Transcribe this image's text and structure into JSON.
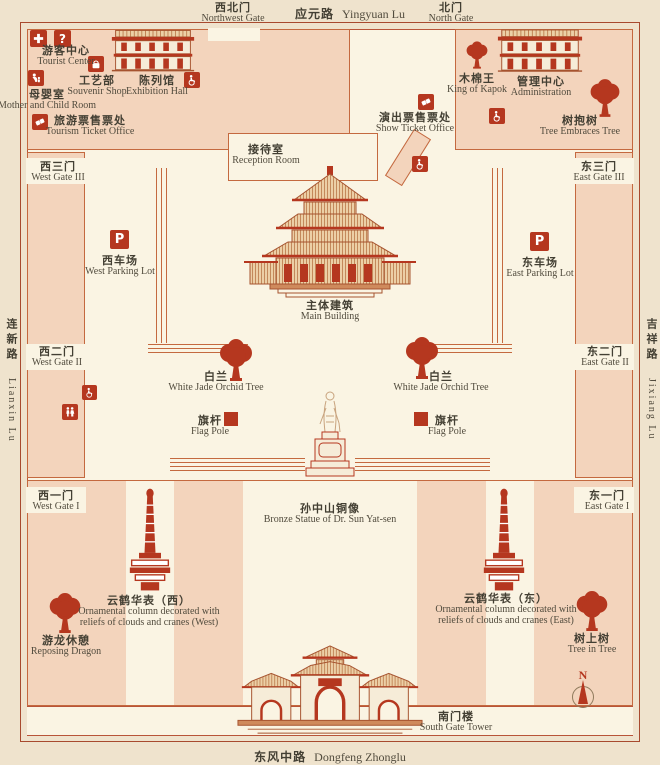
{
  "colors": {
    "accent": "#b5371f",
    "path_pink": "#f3d4bc",
    "outline": "#c4693f",
    "background": "#efe3cd",
    "paper": "#faf4e3",
    "ink": "#433f33"
  },
  "roads": {
    "top": {
      "zh": "应元路",
      "en": "Yingyuan Lu"
    },
    "bottom": {
      "zh": "东风中路",
      "en": "Dongfeng Zhonglu"
    },
    "left": {
      "zh": "连新路",
      "en": "Lianxin Lu"
    },
    "right": {
      "zh": "吉祥路",
      "en": "Jixiang Lu"
    }
  },
  "gates": {
    "northwest": {
      "zh": "西北门",
      "en": "Northwest Gate"
    },
    "north": {
      "zh": "北门",
      "en": "North Gate"
    },
    "west3": {
      "zh": "西三门",
      "en": "West Gate III"
    },
    "east3": {
      "zh": "东三门",
      "en": "East Gate III"
    },
    "west2": {
      "zh": "西二门",
      "en": "West Gate II"
    },
    "east2": {
      "zh": "东二门",
      "en": "East Gate II"
    },
    "west1": {
      "zh": "西一门",
      "en": "West Gate I"
    },
    "east1": {
      "zh": "东一门",
      "en": "East Gate I"
    }
  },
  "pois": {
    "tourist_center": {
      "zh": "游客中心",
      "en": "Tourist Center"
    },
    "souvenir_shop": {
      "zh": "工艺部",
      "en": "Souvenir Shop"
    },
    "exhibition_hall": {
      "zh": "陈列馆",
      "en": "Exhibition Hall"
    },
    "mother_child_room": {
      "zh": "母婴室",
      "en": "Mother and Child Room"
    },
    "tourism_ticket_office": {
      "zh": "旅游票售票处",
      "en": "Tourism Ticket Office"
    },
    "king_of_kapok": {
      "zh": "木棉王",
      "en": "King of Kapok"
    },
    "administration": {
      "zh": "管理中心",
      "en": "Administration"
    },
    "tree_embraces_tree": {
      "zh": "树抱树",
      "en": "Tree Embraces Tree"
    },
    "show_ticket_office": {
      "zh": "演出票售票处",
      "en": "Show Ticket Office"
    },
    "reception_room": {
      "zh": "接待室",
      "en": "Reception Room"
    },
    "main_building": {
      "zh": "主体建筑",
      "en": "Main Building"
    },
    "west_parking": {
      "zh": "西车场",
      "en": "West Parking Lot"
    },
    "east_parking": {
      "zh": "东车场",
      "en": "East Parking Lot"
    },
    "white_jade_orchid_west": {
      "zh": "白兰",
      "en": "White Jade Orchid Tree"
    },
    "white_jade_orchid_east": {
      "zh": "白兰",
      "en": "White Jade Orchid Tree"
    },
    "flag_pole_west": {
      "zh": "旗杆",
      "en": "Flag Pole"
    },
    "flag_pole_east": {
      "zh": "旗杆",
      "en": "Flag Pole"
    },
    "sun_yatsen_statue": {
      "zh": "孙中山铜像",
      "en": "Bronze Statue of Dr. Sun Yat-sen"
    },
    "ornamental_column_west": {
      "zh": "云鹤华表（西）",
      "en": "Ornamental column decorated with reliefs of clouds and cranes (West)"
    },
    "ornamental_column_east": {
      "zh": "云鹤华表（东）",
      "en": "Ornamental column decorated with reliefs of clouds and cranes (East)"
    },
    "reposing_dragon": {
      "zh": "游龙休憩",
      "en": "Reposing Dragon"
    },
    "tree_in_tree": {
      "zh": "树上树",
      "en": "Tree in Tree"
    },
    "south_gate_tower": {
      "zh": "南门楼",
      "en": "South Gate Tower"
    }
  },
  "icons": {
    "question_mark": "?",
    "parking": "P",
    "compass_north": "N"
  }
}
